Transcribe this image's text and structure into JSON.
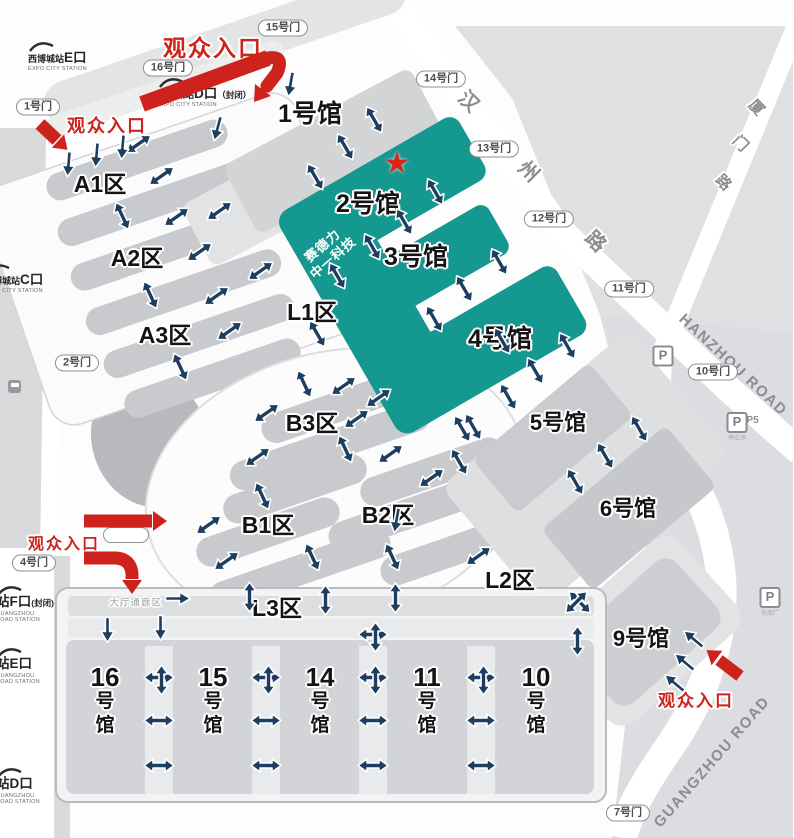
{
  "entrance_label": "观众入口",
  "entrances": [
    {
      "x": 213,
      "y": 46,
      "size": 23
    },
    {
      "x": 107,
      "y": 125,
      "size": 18
    },
    {
      "x": 64,
      "y": 542,
      "size": 16
    },
    {
      "x": 696,
      "y": 699,
      "size": 17
    }
  ],
  "gates": [
    {
      "label": "1号门",
      "x": 38,
      "y": 107
    },
    {
      "label": "16号门",
      "x": 168,
      "y": 68
    },
    {
      "label": "15号门",
      "x": 283,
      "y": 28
    },
    {
      "label": "14号门",
      "x": 441,
      "y": 79
    },
    {
      "label": "13号门",
      "x": 494,
      "y": 149
    },
    {
      "label": "12号门",
      "x": 549,
      "y": 219
    },
    {
      "label": "11号门",
      "x": 629,
      "y": 289
    },
    {
      "label": "10号门",
      "x": 713,
      "y": 372
    },
    {
      "label": "2号门",
      "x": 77,
      "y": 363
    },
    {
      "label": "4号门",
      "x": 34,
      "y": 563
    },
    {
      "label": "7号门",
      "x": 628,
      "y": 813
    },
    {
      "label": "",
      "x": 126,
      "y": 535
    }
  ],
  "stations": [
    {
      "pre": "西博城站",
      "big": "E口",
      "suffix": "",
      "sub": "EXPO CITY STATION",
      "x": 28,
      "y": 42
    },
    {
      "pre": "西博城站",
      "big": "D口",
      "suffix": "（封闭）",
      "sub": "EXPO CITY STATION",
      "x": 158,
      "y": 78
    },
    {
      "pre": "西博城站",
      "big": "C口",
      "suffix": "",
      "sub": "EXPO CITY STATION",
      "x": -16,
      "y": 264
    },
    {
      "pre": "",
      "big": "站F口",
      "suffix": "(封闭)",
      "sub": "GUANGZHOU ROAD STATION",
      "x": -4,
      "y": 586
    },
    {
      "pre": "",
      "big": "站E口",
      "suffix": "",
      "sub": "GUANGZHOU ROAD STATION",
      "x": -4,
      "y": 648
    },
    {
      "pre": "",
      "big": "站D口",
      "suffix": "",
      "sub": "GUANGZHOU ROAD STATION",
      "x": -4,
      "y": 768
    }
  ],
  "halls": [
    {
      "label": "1号馆",
      "x": 310,
      "y": 112,
      "size": 25
    },
    {
      "label": "2号馆",
      "x": 368,
      "y": 202,
      "size": 25
    },
    {
      "label": "3号馆",
      "x": 416,
      "y": 255,
      "size": 25
    },
    {
      "label": "4号馆",
      "x": 500,
      "y": 337,
      "size": 25
    },
    {
      "label": "5号馆",
      "x": 558,
      "y": 421,
      "size": 22
    },
    {
      "label": "6号馆",
      "x": 628,
      "y": 507,
      "size": 22
    },
    {
      "label": "9号馆",
      "x": 641,
      "y": 637,
      "size": 22
    }
  ],
  "vhalls": [
    {
      "num": "16",
      "x": 105
    },
    {
      "num": "15",
      "x": 213
    },
    {
      "num": "14",
      "x": 320
    },
    {
      "num": "11",
      "x": 427
    },
    {
      "num": "10",
      "x": 536
    }
  ],
  "vhall_chars": [
    "号",
    "馆"
  ],
  "zones": [
    {
      "label": "A1区",
      "x": 100,
      "y": 182
    },
    {
      "label": "A2区",
      "x": 137,
      "y": 256
    },
    {
      "label": "A3区",
      "x": 165,
      "y": 333
    },
    {
      "label": "B3区",
      "x": 312,
      "y": 421
    },
    {
      "label": "B1区",
      "x": 268,
      "y": 523
    },
    {
      "label": "B2区",
      "x": 388,
      "y": 513
    },
    {
      "label": "L1区",
      "x": 312,
      "y": 310
    },
    {
      "label": "L2区",
      "x": 510,
      "y": 578
    },
    {
      "label": "L3区",
      "x": 277,
      "y": 606
    }
  ],
  "star": {
    "glyph": "★",
    "x": 397,
    "y": 164
  },
  "booth": {
    "line1": "赛德力",
    "line2": "中一科技"
  },
  "corridor": {
    "label": "大厅通廊区"
  },
  "roads": {
    "hanzhou_chars": [
      {
        "ch": "汉",
        "x": 470,
        "y": 100
      },
      {
        "ch": "州",
        "x": 530,
        "y": 170
      },
      {
        "ch": "路",
        "x": 597,
        "y": 240
      }
    ],
    "hanzhou_en": {
      "text": "HANZHOU ROAD"
    },
    "xiamen_chars": [
      {
        "ch": "厦",
        "x": 757,
        "y": 107
      },
      {
        "ch": "门",
        "x": 741,
        "y": 143
      },
      {
        "ch": "路",
        "x": 724,
        "y": 182
      }
    ],
    "guangzhou_en": {
      "text": "GUANGZHOU ROAD"
    }
  },
  "parkings": [
    {
      "x": 663,
      "y": 356,
      "label": "P",
      "sub": "",
      "note": ""
    },
    {
      "x": 737,
      "y": 427,
      "label": "P",
      "sub": "P5",
      "note": "停车场"
    },
    {
      "x": 770,
      "y": 602,
      "label": "P",
      "sub": "",
      "note": "东南广"
    }
  ],
  "arrows": {
    "double": [
      [
        343,
        148,
        60
      ],
      [
        313,
        178,
        60
      ],
      [
        372,
        121,
        60
      ],
      [
        433,
        193,
        60
      ],
      [
        402,
        223,
        60
      ],
      [
        370,
        248,
        60
      ],
      [
        335,
        277,
        60
      ],
      [
        497,
        263,
        60
      ],
      [
        462,
        290,
        60
      ],
      [
        432,
        320,
        60
      ],
      [
        500,
        342,
        60
      ],
      [
        533,
        372,
        60
      ],
      [
        565,
        347,
        60
      ],
      [
        315,
        335,
        60
      ],
      [
        460,
        430,
        60
      ],
      [
        140,
        146,
        -35
      ],
      [
        163,
        178,
        -35
      ],
      [
        120,
        217,
        65
      ],
      [
        178,
        219,
        -35
      ],
      [
        221,
        213,
        -35
      ],
      [
        201,
        254,
        -35
      ],
      [
        262,
        273,
        -35
      ],
      [
        148,
        296,
        65
      ],
      [
        218,
        298,
        -35
      ],
      [
        231,
        333,
        -35
      ],
      [
        178,
        368,
        65
      ],
      [
        302,
        385,
        65
      ],
      [
        345,
        388,
        -35
      ],
      [
        380,
        400,
        -35
      ],
      [
        268,
        415,
        -35
      ],
      [
        358,
        421,
        -35
      ],
      [
        259,
        459,
        -35
      ],
      [
        343,
        450,
        65
      ],
      [
        392,
        456,
        -35
      ],
      [
        433,
        480,
        -35
      ],
      [
        260,
        497,
        65
      ],
      [
        210,
        527,
        -35
      ],
      [
        228,
        563,
        -35
      ],
      [
        310,
        558,
        65
      ],
      [
        390,
        558,
        65
      ],
      [
        480,
        558,
        -35
      ],
      [
        247,
        597,
        90
      ],
      [
        323,
        600,
        90
      ],
      [
        393,
        598,
        90
      ],
      [
        506,
        398,
        60
      ],
      [
        471,
        428,
        60
      ],
      [
        637,
        430,
        60
      ],
      [
        603,
        457,
        60
      ],
      [
        573,
        483,
        60
      ],
      [
        457,
        463,
        60
      ],
      [
        578,
        604,
        45
      ],
      [
        578,
        604,
        -45
      ],
      [
        159,
        723,
        0
      ],
      [
        159,
        768,
        0
      ],
      [
        266,
        723,
        0
      ],
      [
        266,
        768,
        0
      ],
      [
        373,
        723,
        0
      ],
      [
        373,
        768,
        0
      ],
      [
        481,
        723,
        0
      ],
      [
        481,
        768,
        0
      ],
      [
        575,
        641,
        90
      ]
    ],
    "single": [
      [
        66,
        164,
        95
      ],
      [
        94,
        155,
        95
      ],
      [
        120,
        147,
        95
      ],
      [
        215,
        128,
        105
      ],
      [
        288,
        84,
        100
      ],
      [
        178,
        601,
        0
      ],
      [
        105,
        630,
        90
      ],
      [
        158,
        628,
        90
      ],
      [
        394,
        520,
        100
      ],
      [
        695,
        637,
        -140
      ],
      [
        686,
        660,
        -140
      ],
      [
        676,
        681,
        -140
      ]
    ],
    "cross": [
      [
        159,
        680
      ],
      [
        266,
        680
      ],
      [
        373,
        680
      ],
      [
        481,
        680
      ],
      [
        373,
        637
      ]
    ]
  }
}
